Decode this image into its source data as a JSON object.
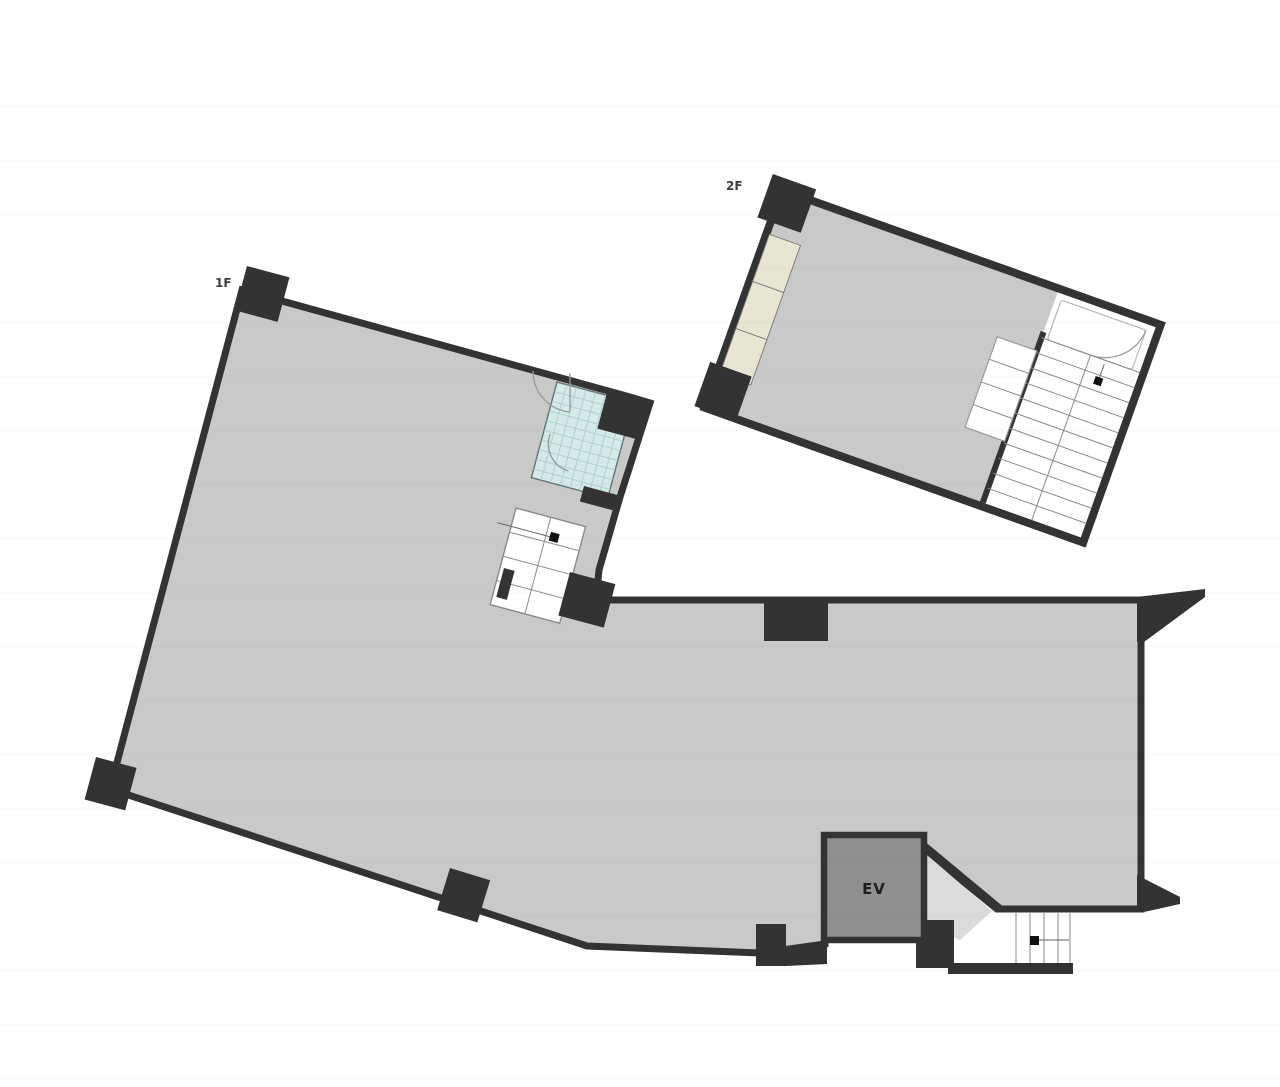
{
  "document": {
    "type": "building-floor-plan",
    "background": "#ffffff"
  },
  "floors": [
    {
      "id": "1F",
      "label": "1F",
      "features": [
        "bathroom",
        "internal-stairs",
        "elevator",
        "entrance-steps"
      ]
    },
    {
      "id": "2F",
      "label": "2F",
      "features": [
        "balcony-strip",
        "stairwell",
        "landing"
      ]
    }
  ],
  "elevator": {
    "label": "EV"
  },
  "colors": {
    "floor_fill": "#c9c9c9",
    "wall": "#333333",
    "bathroom_tile": "#d4e9e8",
    "bathroom_grid": "#abcfce",
    "balcony_fill": "#e8e5d2",
    "elevator_fill": "#8f8f8f",
    "vestibule_fill": "#dbdbdb",
    "stair_line": "#8a8a8a",
    "label_color": "#3c3c3c"
  }
}
